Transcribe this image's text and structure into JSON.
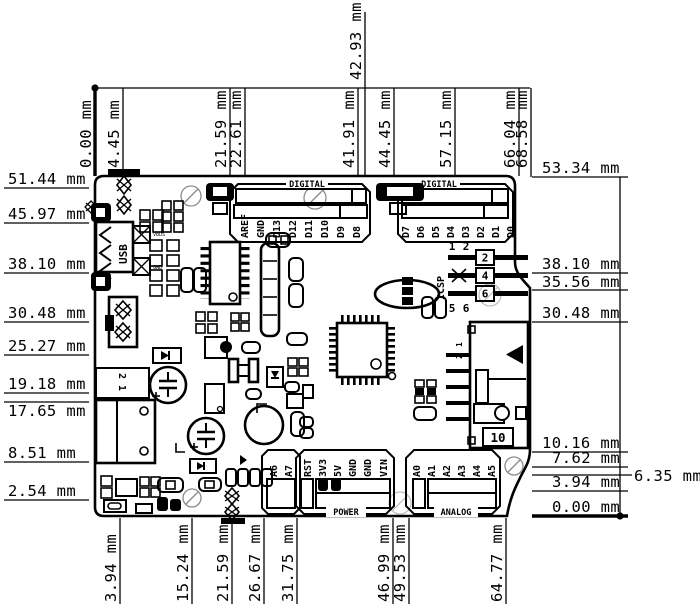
{
  "title": "Arduino board mechanical dimension drawing",
  "unit": "mm",
  "colors": {
    "ink": "#000000",
    "background": "#ffffff",
    "hole_mark": "#8a8a8a"
  },
  "dims": {
    "top": [
      "0.00 mm",
      "4.45 mm",
      "21.59 mm",
      "22.61 mm",
      "41.91 mm",
      "42.93 mm",
      "44.45 mm",
      "57.15 mm",
      "66.04 mm",
      "68.58 mm"
    ],
    "left": [
      "51.44 mm",
      "45.97 mm",
      "38.10 mm",
      "30.48 mm",
      "25.27 mm",
      "19.18 mm",
      "17.65 mm",
      "8.51 mm",
      "2.54 mm"
    ],
    "right": [
      "53.34 mm",
      "38.10 mm",
      "35.56 mm",
      "30.48 mm",
      "10.16 mm",
      "7.62 mm",
      "6.35 mm",
      "3.94 mm",
      "0.00 mm"
    ],
    "bottom": [
      "3.94 mm",
      "15.24 mm",
      "21.59 mm",
      "26.67 mm",
      "31.75 mm",
      "46.99 mm",
      "49.53 mm",
      "64.77 mm"
    ]
  },
  "headers": {
    "digital_left": {
      "title": "DIGITAL",
      "pins": [
        "AREF",
        "GND",
        "D13",
        "D12",
        "D11",
        "D10",
        "D9",
        "D8"
      ]
    },
    "digital_right": {
      "title": "DIGITAL",
      "pins": [
        "D7",
        "D6",
        "D5",
        "D4",
        "D3",
        "D2",
        "D1",
        "D0"
      ]
    },
    "power": {
      "title": "POWER",
      "pins": [
        "RST",
        "3V3",
        "5V",
        "GND",
        "GND",
        "VIN"
      ]
    },
    "aux": {
      "pins": [
        "A6",
        "A7"
      ]
    },
    "analog": {
      "title": "ANALOG",
      "pins": [
        "A0",
        "A1",
        "A2",
        "A3",
        "A4",
        "A5"
      ]
    }
  },
  "icsp": {
    "label": "ICSP",
    "top_pins": [
      "1",
      "2"
    ],
    "boxes": [
      "2",
      "4",
      "6"
    ],
    "bottom_pins": [
      "5",
      "6"
    ]
  },
  "usb": {
    "label": "USB",
    "pads": [
      "VBUS",
      "GND"
    ]
  },
  "right_connector": {
    "pins": [
      "1",
      "2"
    ],
    "ref": "10"
  },
  "power_jack": {
    "pins": "2 1"
  }
}
